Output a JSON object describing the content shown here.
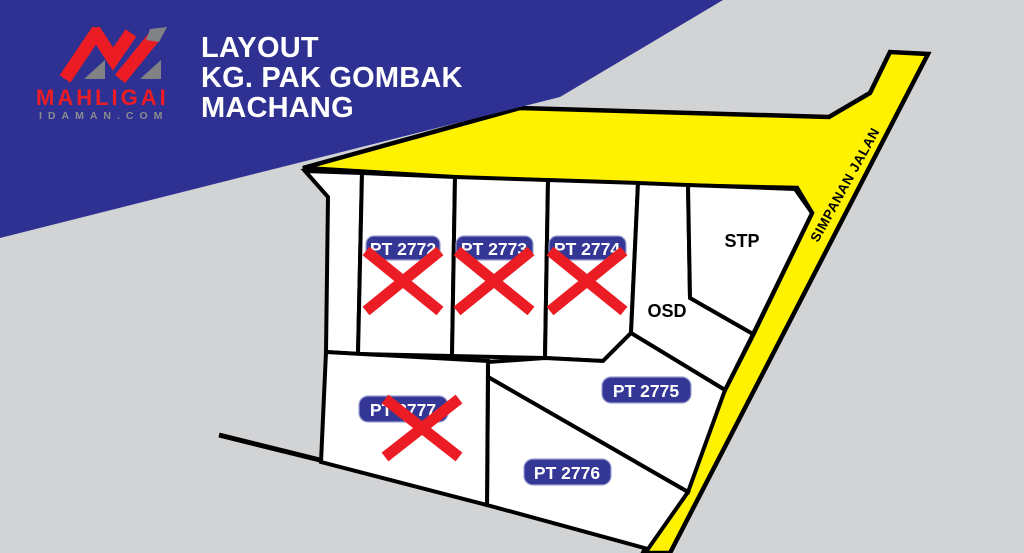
{
  "header": {
    "title_line1": "LAYOUT",
    "title_line2": "KG. PAK GOMBAK",
    "title_line3": "MACHANG"
  },
  "logo": {
    "brand": "MAHLIGAI",
    "domain": "IDAMAN.COM"
  },
  "map": {
    "road_label": "SIMPANAN JALAN",
    "areas": {
      "stp": "STP",
      "osd": "OSD"
    },
    "plots": [
      {
        "label": "PT 2772",
        "status": "crossed-out"
      },
      {
        "label": "PT 2773",
        "status": "crossed-out"
      },
      {
        "label": "PT 2774",
        "status": "crossed-out"
      },
      {
        "label": "PT 2775",
        "status": "available"
      },
      {
        "label": "PT 2776",
        "status": "available"
      },
      {
        "label": "PT 2777",
        "status": "crossed-out"
      }
    ]
  },
  "colors": {
    "banner_blue": "#2e3192",
    "label_blue": "#2e3192",
    "road_yellow": "#fff200",
    "background_gray": "#d2d3d5",
    "plot_white": "#ffffff",
    "line_black": "#000000",
    "cross_red": "#ec1c24",
    "logo_red": "#ec1c24",
    "logo_gray": "#8a8c8e"
  }
}
